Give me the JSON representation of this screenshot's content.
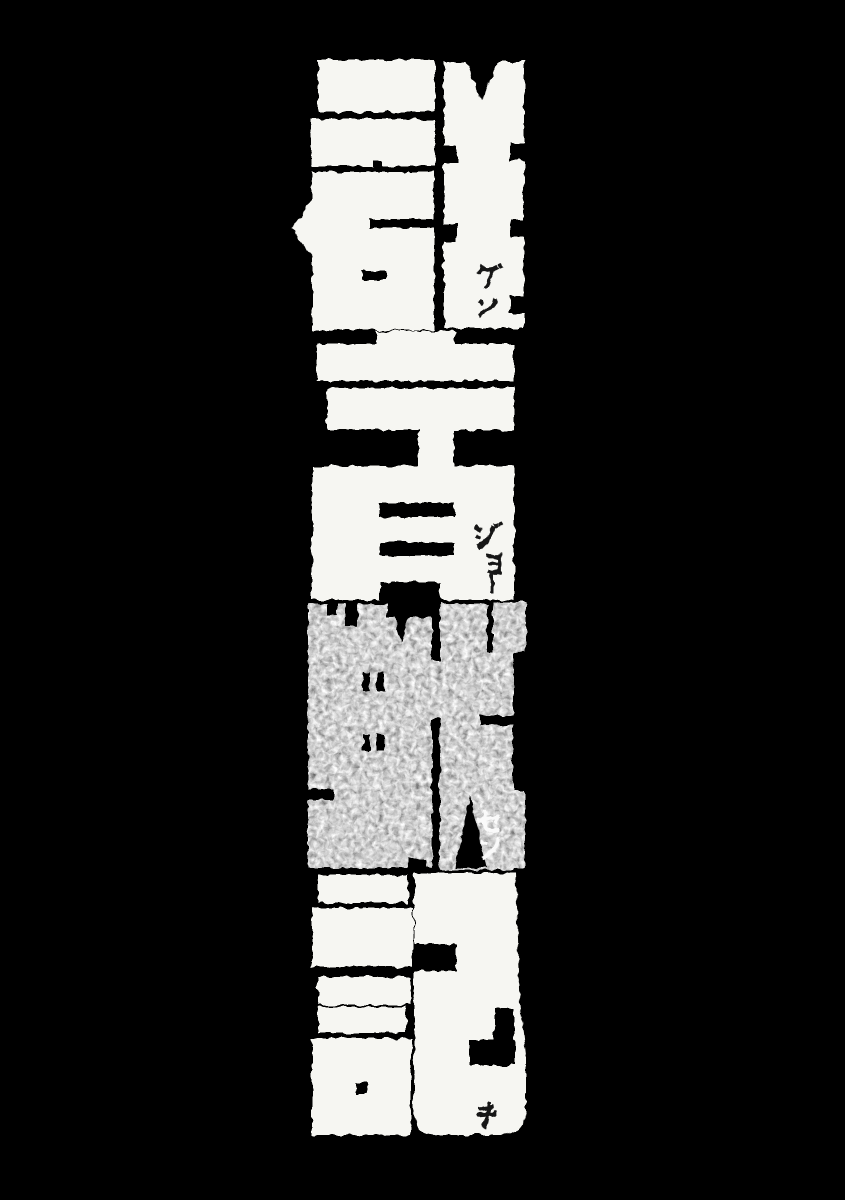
{
  "title": {
    "text": "群青戦記",
    "reading": "グンジョーセンキ",
    "orientation": "vertical-top-to-bottom",
    "characters": [
      {
        "char": "群",
        "furigana": "グン",
        "style": "white",
        "furigana_color": "#161616"
      },
      {
        "char": "青",
        "furigana": "ジョー",
        "style": "white",
        "furigana_color": "#161616"
      },
      {
        "char": "戦",
        "furigana": "セン",
        "style": "gray-texture",
        "furigana_color": "#fafafa"
      },
      {
        "char": "記",
        "furigana": "キ",
        "style": "white",
        "furigana_color": "#161616"
      }
    ]
  },
  "colors": {
    "background": "#000000",
    "glyph_white": "#f6f6f2",
    "glyph_gray_texture": "#8f8f8f",
    "furigana_dark": "#161616",
    "furigana_light": "#fafafa"
  }
}
